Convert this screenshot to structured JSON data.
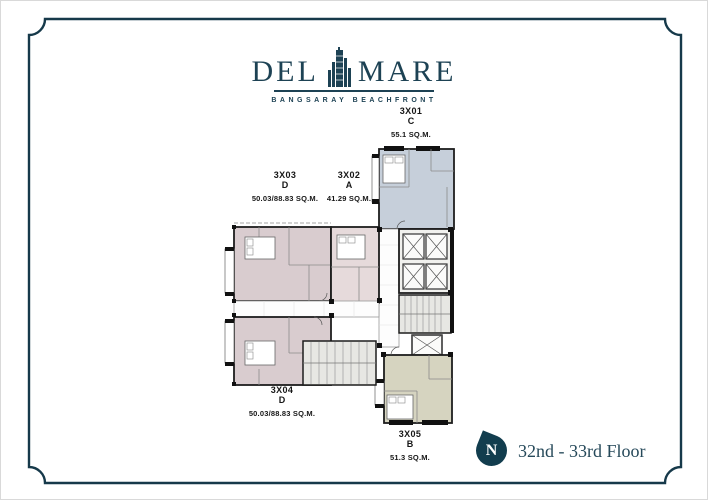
{
  "logo": {
    "brand_left": "DEL",
    "brand_right": "MARE",
    "tagline": "BANGSARAY BEACHFRONT"
  },
  "units": {
    "u3x01": {
      "id": "3X01",
      "type": "C",
      "area": "55.1 SQ.M.",
      "color": "#c6cfda"
    },
    "u3x02": {
      "id": "3X02",
      "type": "A",
      "area": "41.29 SQ.M.",
      "color": "#e6dadb"
    },
    "u3x03": {
      "id": "3X03",
      "type": "D",
      "area": "50.03/88.83 SQ.M.",
      "color": "#d9cccf"
    },
    "u3x04": {
      "id": "3X04",
      "type": "D",
      "area": "50.03/88.83 SQ.M.",
      "color": "#d9cccf"
    },
    "u3x05": {
      "id": "3X05",
      "type": "B",
      "area": "51.3 SQ.M.",
      "color": "#d6d4c0"
    }
  },
  "footer": {
    "compass_letter": "N",
    "floor_label": "32nd - 33rd Floor"
  },
  "colors": {
    "accent": "#1d4254",
    "frame": "#16394a",
    "wall": "#1d1d1d",
    "core_fill": "#f1f1ee",
    "stair_fill": "#e7e7e3"
  }
}
